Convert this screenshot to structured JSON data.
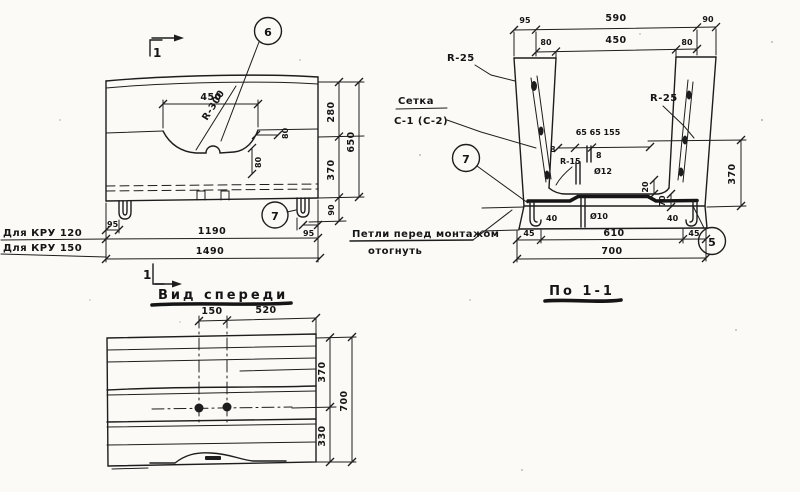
{
  "colors": {
    "ink": "#1d1d1d",
    "paper": "#fbfaf6"
  },
  "drawing": {
    "elevation": {
      "section_mark": "1",
      "callout_6": "6",
      "callout_7": "7",
      "dim_recess_width": "450",
      "dim_recess_radius": "R-300",
      "dim_notch_80a": "80",
      "dim_notch_80b": "80",
      "dim_right_280": "280",
      "dim_right_370": "370",
      "dim_right_90": "90",
      "dim_right_650": "650",
      "dim_lug_left_95": "95",
      "dim_lug_right_95": "95",
      "dim_length_1190": "1190",
      "dim_length_1490": "1490",
      "note_row1": "Для КРУ 120",
      "note_row2": "Для КРУ 150"
    },
    "front_view": {
      "title": "Вид спереди",
      "section_mark": "1",
      "dim_150": "150",
      "dim_520": "520",
      "dim_370": "370",
      "dim_330": "330",
      "dim_700": "700"
    },
    "section": {
      "title": "По 1-1",
      "dim_top_95": "95",
      "dim_top_590": "590",
      "dim_top_90": "90",
      "dim_top2_80l": "80",
      "dim_top2_450": "450",
      "dim_top2_80r": "80",
      "label_r25_left": "R-25",
      "label_r25_right": "R-25",
      "mesh_label_line1": "Сетка",
      "mesh_label_line2": "С-1 (С-2)",
      "dim_inner_chain": "65 65 155",
      "dim_inner_8l": "8",
      "dim_inner_8r": "8",
      "label_r15": "R-15",
      "label_d12": "Ø12",
      "label_d10": "Ø10",
      "dim_20": "20",
      "dim_70": "70",
      "dim_40_left": "40",
      "dim_40_right": "40",
      "dim_bottom_45l": "45",
      "dim_bottom_610": "610",
      "dim_bottom_45r": "45",
      "dim_bottom_700": "700",
      "dim_right_370": "370",
      "callout_7": "7",
      "callout_5": "5",
      "note_line1": "Петли перед монтажом",
      "note_line2": "отогнуть"
    }
  }
}
